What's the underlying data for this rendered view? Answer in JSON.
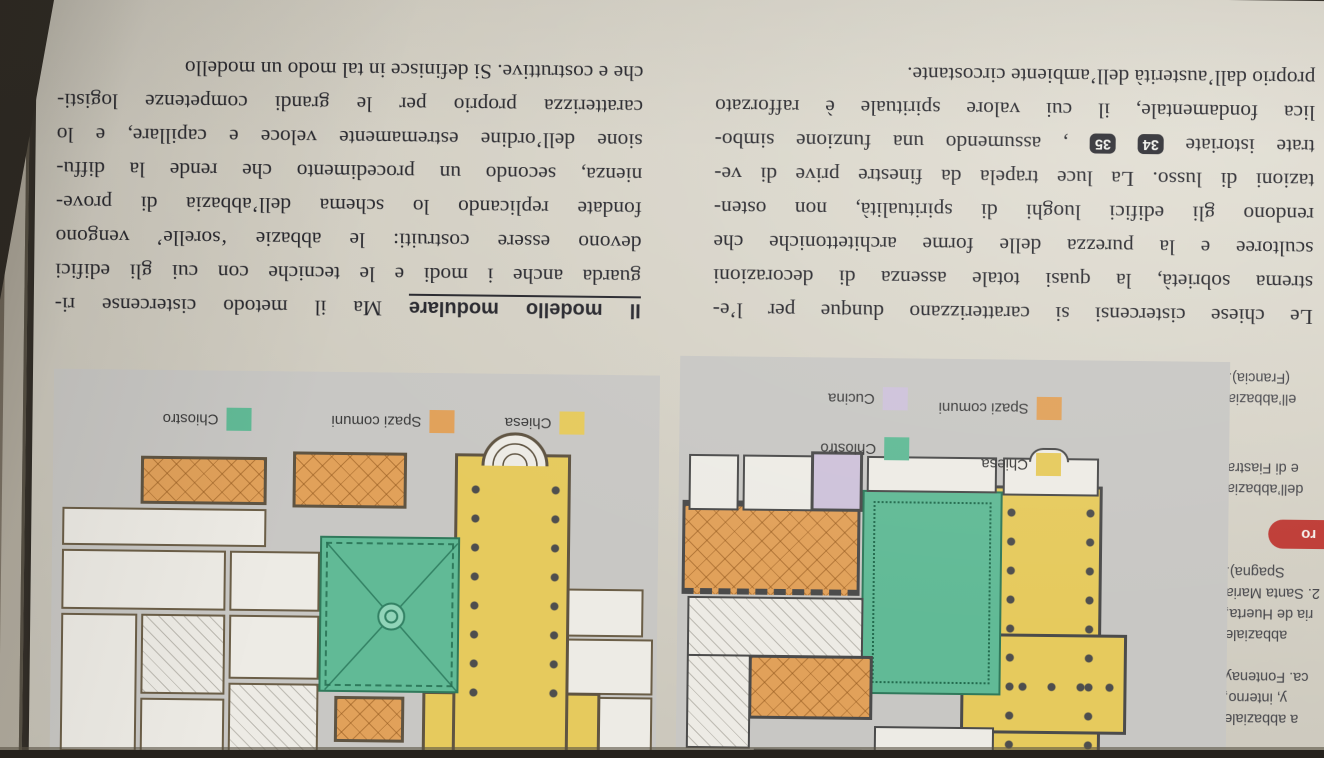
{
  "text_columns": {
    "left": {
      "lines": [
        "Le chiese cistercensi si caratterizzano dunque per l’e-",
        "strema sobrietà, la quasi totale assenza di decorazioni",
        "scultoree e la purezza delle forme architettoniche che",
        "rendono gli edifici luoghi di spiritualità, non osten-",
        "tazioni di lusso. La luce trapela da finestre prive di ve-"
      ],
      "line6_pre": "trate istoriate",
      "line6_post": ", assumendo una funzione simbo-",
      "figure_badges": [
        "34",
        "35"
      ],
      "lines_tail": [
        "lica fondamentale, il cui valore spirituale è rafforzato",
        "proprio dall’austerità dell’ambiente circostante."
      ]
    },
    "right": {
      "heading": "Il modello modulare",
      "heading_rest": "Ma il metodo cistercense ri-",
      "lines": [
        "guarda anche i modi e le tecniche con cui gli edifici",
        "devono essere costruiti: le abbazie ‘sorelle’ vengono",
        "fondate replicando lo schema dell’abbazia di prove-",
        "nienza, secondo un procedimento che rende la diffu-",
        "sione dell’ordine estremamente veloce e capillare, e lo",
        "caratterizza proprio per le grandi competenze logisti-",
        "che e costruttive. Si definisce in tal modo un modello"
      ]
    }
  },
  "margin_captions": {
    "group_fontenay_interno": [
      "a abbaziale",
      "y, interno,",
      "ca. Fontenay"
    ],
    "group_santa_maria": [
      "abbaziale",
      "ria de Huerta,",
      "2. Santa Maria",
      "Spagna)."
    ],
    "red_badge_fragment": "ro",
    "group_fiastra": [
      "dell’abbazia",
      "e di Fiastra"
    ],
    "group_francia": [
      "ell’abbazia",
      "(Francia)."
    ]
  },
  "figures": {
    "left_panel_legend": [
      {
        "label": "Chiesa",
        "color": "#e9cb58"
      },
      {
        "label": "Chiostro",
        "color": "#5ebc96"
      },
      {
        "label": "Spazi comuni",
        "color": "#e5a156"
      },
      {
        "label": "Cucina",
        "color": "#cfc3dc"
      }
    ],
    "right_panel_legend": [
      {
        "label": "Chiesa",
        "color": "#e9cb58"
      },
      {
        "label": "Spazi comuni",
        "color": "#e5a156"
      },
      {
        "label": "Chiostro",
        "color": "#5ebc96"
      }
    ]
  },
  "colors": {
    "page": "#d6d2c6",
    "panel_background": "#c9c8c5",
    "text": "#26262c",
    "figure_badge_background": "#2b2b31",
    "red_badge": "#c43b35",
    "chiesa": "#e9cb58",
    "chiostro": "#5ebc96",
    "spazi_comuni": "#e5a156",
    "cucina": "#cfc3dc"
  }
}
